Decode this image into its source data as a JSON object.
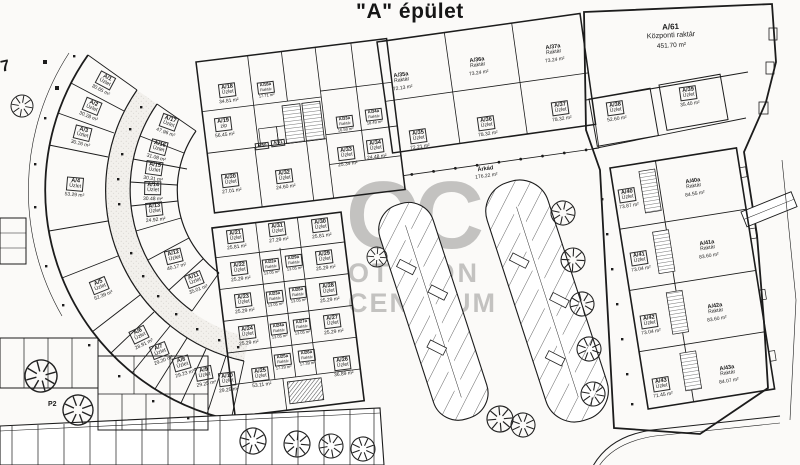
{
  "title": "\"A\" épület",
  "watermark": {
    "monogram": "OC",
    "line1": "OTTHON",
    "line2": "CENTRUM"
  },
  "labels": {
    "p2": "P2",
    "corner": "7"
  },
  "rooms": [
    {
      "code": "A/1",
      "type": "Üzlet",
      "area": "30.65 m²",
      "x": 104,
      "y": 84,
      "rot": 28,
      "boxed": true
    },
    {
      "code": "A/2",
      "type": "Üzlet",
      "area": "30.28 m²",
      "x": 91,
      "y": 110,
      "rot": 22,
      "boxed": true
    },
    {
      "code": "A/3",
      "type": "Üzlet",
      "area": "30.26 m²",
      "x": 82,
      "y": 137,
      "rot": 14,
      "boxed": true
    },
    {
      "code": "A/4",
      "type": "Üzlet",
      "area": "53.29 m²",
      "x": 75,
      "y": 188,
      "rot": 5,
      "boxed": true
    },
    {
      "code": "A/5",
      "type": "Üzlet",
      "area": "52.39 m²",
      "x": 101,
      "y": 289,
      "rot": -22,
      "boxed": true
    },
    {
      "code": "A/6",
      "type": "Üzlet",
      "area": "28.91 m²",
      "x": 141,
      "y": 338,
      "rot": -26,
      "boxed": true
    },
    {
      "code": "A/7",
      "type": "Üzlet",
      "area": "29.20 m²",
      "x": 161,
      "y": 354,
      "rot": -21,
      "boxed": true
    },
    {
      "code": "A/8",
      "type": "Üzlet",
      "area": "29.23 m²",
      "x": 183,
      "y": 367,
      "rot": -16,
      "boxed": true
    },
    {
      "code": "A/9",
      "type": "Üzlet",
      "area": "29.25 m²",
      "x": 205,
      "y": 377,
      "rot": -11,
      "boxed": true
    },
    {
      "code": "A/10",
      "type": "Üzlet",
      "area": "29.25 m²",
      "x": 228,
      "y": 383,
      "rot": -7,
      "boxed": true
    },
    {
      "code": "A/11",
      "type": "Üzlet",
      "area": "35.01 m²",
      "x": 196,
      "y": 283,
      "rot": -21,
      "boxed": true
    },
    {
      "code": "A/12",
      "type": "Üzlet",
      "area": "40.17 m²",
      "x": 175,
      "y": 260,
      "rot": -14,
      "boxed": true
    },
    {
      "code": "A/13",
      "type": "Üzlet",
      "area": "24.92 m²",
      "x": 155,
      "y": 213,
      "rot": -6,
      "boxed": true
    },
    {
      "code": "A/14",
      "type": "Üzlet",
      "area": "30.48 m²",
      "x": 153,
      "y": 192,
      "rot": 1,
      "boxed": true
    },
    {
      "code": "A/15",
      "type": "Üzlet",
      "area": "30.31 m²",
      "x": 154,
      "y": 172,
      "rot": 8,
      "boxed": true
    },
    {
      "code": "A/16",
      "type": "Üzlet",
      "area": "31.08 m²",
      "x": 158,
      "y": 151,
      "rot": 15,
      "boxed": true
    },
    {
      "code": "A/17",
      "type": "Üzlet",
      "area": "47.96 m²",
      "x": 168,
      "y": 126,
      "rot": 20,
      "boxed": true
    },
    {
      "code": "A/18",
      "type": "Üzlet",
      "area": "34.81 m²",
      "x": 228,
      "y": 94,
      "rot": -7,
      "boxed": true
    },
    {
      "code": "A/18a",
      "type": "Raktár",
      "area": "17.71 m²",
      "x": 266,
      "y": 90,
      "rot": -7,
      "boxed": true,
      "size": "xs"
    },
    {
      "code": "A/19",
      "type": "zip",
      "area": "56.45 m²",
      "x": 224,
      "y": 128,
      "rot": -7,
      "boxed": true
    },
    {
      "code": "A/50",
      "type": "",
      "area": "",
      "x": 262,
      "y": 146,
      "rot": -7,
      "boxed": true,
      "size": "xs"
    },
    {
      "code": "A/51",
      "type": "",
      "area": "",
      "x": 278,
      "y": 143,
      "rot": -7,
      "boxed": true,
      "size": "xs"
    },
    {
      "code": "A/20",
      "type": "Üzlet",
      "area": "27.01 m²",
      "x": 231,
      "y": 184,
      "rot": -7,
      "boxed": true
    },
    {
      "code": "A/32",
      "type": "Üzlet",
      "area": "24.60 m²",
      "x": 285,
      "y": 180,
      "rot": -7,
      "boxed": true
    },
    {
      "code": "A/33a",
      "type": "Raktár",
      "area": "16.58 m²",
      "x": 345,
      "y": 124,
      "rot": -7,
      "boxed": true,
      "size": "xs"
    },
    {
      "code": "A/34a",
      "type": "Raktár",
      "area": "18.49 m²",
      "x": 374,
      "y": 117,
      "rot": -7,
      "boxed": true,
      "size": "xs"
    },
    {
      "code": "A/33",
      "type": "Üzlet",
      "area": "25.34 m²",
      "x": 347,
      "y": 157,
      "rot": -7,
      "boxed": true
    },
    {
      "code": "A/34",
      "type": "Üzlet",
      "area": "24.48 m²",
      "x": 376,
      "y": 150,
      "rot": -7,
      "boxed": true
    },
    {
      "code": "A/35a",
      "type": "Raktár",
      "area": "72.13 m²",
      "x": 402,
      "y": 82,
      "rot": -8,
      "boxed": false
    },
    {
      "code": "A/36a",
      "type": "Raktár",
      "area": "73.24 m²",
      "x": 478,
      "y": 67,
      "rot": -8,
      "boxed": false
    },
    {
      "code": "A/37a",
      "type": "Raktár",
      "area": "73.24 m²",
      "x": 554,
      "y": 54,
      "rot": -8,
      "boxed": false
    },
    {
      "code": "A/35",
      "type": "Üzlet",
      "area": "72.21 m²",
      "x": 419,
      "y": 140,
      "rot": -8,
      "boxed": true
    },
    {
      "code": "A/36",
      "type": "Üzlet",
      "area": "78.32 m²",
      "x": 487,
      "y": 127,
      "rot": -8,
      "boxed": true
    },
    {
      "code": "A/37",
      "type": "Üzlet",
      "area": "78.32 m²",
      "x": 561,
      "y": 112,
      "rot": -8,
      "boxed": true
    },
    {
      "code": "Árkád",
      "type": "",
      "area": "176.22 m²",
      "x": 486,
      "y": 173,
      "rot": -8,
      "boxed": false
    },
    {
      "code": "A/61",
      "type": "Központi raktár",
      "area": "451.70 m²",
      "x": 671,
      "y": 36,
      "rot": -3,
      "boxed": false,
      "size": "lg"
    },
    {
      "code": "A/38",
      "type": "Üzlet",
      "area": "52.60 m²",
      "x": 616,
      "y": 112,
      "rot": -8,
      "boxed": true
    },
    {
      "code": "A/39",
      "type": "Üzlet",
      "area": "35.40 m²",
      "x": 689,
      "y": 97,
      "rot": -8,
      "boxed": true
    },
    {
      "code": "A/21",
      "type": "Üzlet",
      "area": "25.81 m²",
      "x": 236,
      "y": 240,
      "rot": -7,
      "boxed": true
    },
    {
      "code": "A/22",
      "type": "Üzlet",
      "area": "25.29 m²",
      "x": 240,
      "y": 272,
      "rot": -7,
      "boxed": true
    },
    {
      "code": "A/23",
      "type": "Üzlet",
      "area": "25.29 m²",
      "x": 244,
      "y": 304,
      "rot": -7,
      "boxed": true
    },
    {
      "code": "A/24",
      "type": "Üzlet",
      "area": "25.29 m²",
      "x": 248,
      "y": 336,
      "rot": -7,
      "boxed": true
    },
    {
      "code": "A/25",
      "type": "Üzlet",
      "area": "53.11 m²",
      "x": 261,
      "y": 378,
      "rot": -7,
      "boxed": true
    },
    {
      "code": "A/31",
      "type": "Üzlet",
      "area": "27.29 m²",
      "x": 278,
      "y": 233,
      "rot": -7,
      "boxed": true
    },
    {
      "code": "A/30",
      "type": "Üzlet",
      "area": "25.81 m²",
      "x": 321,
      "y": 229,
      "rot": -7,
      "boxed": true
    },
    {
      "code": "A/29",
      "type": "Üzlet",
      "area": "25.29 m²",
      "x": 325,
      "y": 261,
      "rot": -7,
      "boxed": true
    },
    {
      "code": "A/28",
      "type": "Üzlet",
      "area": "25.29 m²",
      "x": 329,
      "y": 293,
      "rot": -7,
      "boxed": true
    },
    {
      "code": "A/27",
      "type": "Üzlet",
      "area": "25.29 m²",
      "x": 333,
      "y": 325,
      "rot": -7,
      "boxed": true
    },
    {
      "code": "A/26",
      "type": "Üzlet",
      "area": "36.89 m²",
      "x": 343,
      "y": 367,
      "rot": -7,
      "boxed": true
    },
    {
      "code": "A/22a",
      "type": "Raktár",
      "area": "13.05 m²",
      "x": 271,
      "y": 267,
      "rot": -7,
      "boxed": true,
      "size": "xs"
    },
    {
      "code": "A/29a",
      "type": "Raktár",
      "area": "13.05 m²",
      "x": 294,
      "y": 263,
      "rot": -7,
      "boxed": true,
      "size": "xs"
    },
    {
      "code": "A/23a",
      "type": "Raktár",
      "area": "13.05 m²",
      "x": 275,
      "y": 299,
      "rot": -7,
      "boxed": true,
      "size": "xs"
    },
    {
      "code": "A/28a",
      "type": "Raktár",
      "area": "13.05 m²",
      "x": 298,
      "y": 295,
      "rot": -7,
      "boxed": true,
      "size": "xs"
    },
    {
      "code": "A/24a",
      "type": "Raktár",
      "area": "13.05 m²",
      "x": 279,
      "y": 331,
      "rot": -7,
      "boxed": true,
      "size": "xs"
    },
    {
      "code": "A/27a",
      "type": "Raktár",
      "area": "13.05 m²",
      "x": 302,
      "y": 327,
      "rot": -7,
      "boxed": true,
      "size": "xs"
    },
    {
      "code": "A/25a",
      "type": "Raktár",
      "area": "17.29 m²",
      "x": 283,
      "y": 362,
      "rot": -7,
      "boxed": true,
      "size": "xs"
    },
    {
      "code": "A/26a",
      "type": "Raktár",
      "area": "17.39 m²",
      "x": 307,
      "y": 358,
      "rot": -7,
      "boxed": true,
      "size": "xs"
    },
    {
      "code": "A/40",
      "type": "Üzlet",
      "area": "73.87 m²",
      "x": 628,
      "y": 199,
      "rot": -9,
      "boxed": true
    },
    {
      "code": "A/40a",
      "type": "Raktár",
      "area": "84.55 m²",
      "x": 694,
      "y": 188,
      "rot": -9,
      "boxed": false
    },
    {
      "code": "A/41",
      "type": "Üzlet",
      "area": "73.04 m²",
      "x": 640,
      "y": 262,
      "rot": -9,
      "boxed": true
    },
    {
      "code": "A/41a",
      "type": "Raktár",
      "area": "83.60 m²",
      "x": 708,
      "y": 250,
      "rot": -9,
      "boxed": false
    },
    {
      "code": "A/42",
      "type": "Üzlet",
      "area": "73.04 m²",
      "x": 650,
      "y": 325,
      "rot": -9,
      "boxed": true
    },
    {
      "code": "A/42a",
      "type": "Raktár",
      "area": "83.60 m²",
      "x": 716,
      "y": 313,
      "rot": -9,
      "boxed": false
    },
    {
      "code": "A/43",
      "type": "Üzlet",
      "area": "71.45 m²",
      "x": 662,
      "y": 388,
      "rot": -9,
      "boxed": true
    },
    {
      "code": "A/43a",
      "type": "Raktár",
      "area": "84.07 m²",
      "x": 728,
      "y": 375,
      "rot": -9,
      "boxed": false
    }
  ]
}
